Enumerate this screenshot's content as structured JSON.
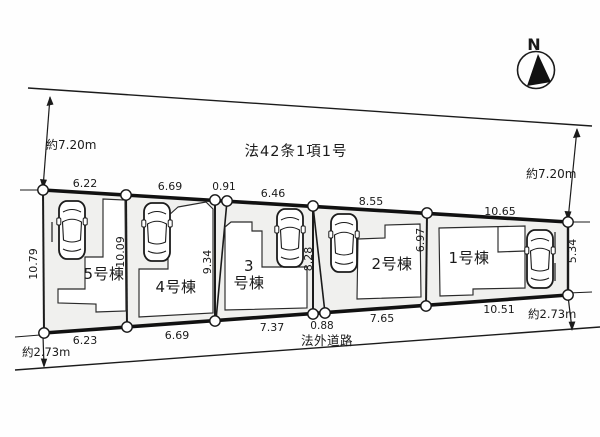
{
  "plan": {
    "compass": {
      "label": "N"
    },
    "north_road": {
      "designation": "法42条1項1号",
      "width_left": "約7.20m",
      "width_right": "約7.20m"
    },
    "south_road": {
      "name": "法外道路",
      "width_left": "約2.73m",
      "width_right": "約2.73m"
    },
    "lots": [
      {
        "label": "1号棟",
        "frontage_top": "10.65",
        "frontage_bottom": "10.51",
        "depth_right": "5.34",
        "depth_left": "6.97"
      },
      {
        "label": "2号棟",
        "frontage_top": "8.55",
        "frontage_bottom": "7.65"
      },
      {
        "label": "3号棟",
        "label_line1": "3",
        "label_line2": "号棟",
        "frontage_top": "6.46",
        "frontage_bottom": "7.37",
        "depth_left": "9.34",
        "depth_right": "8.28"
      },
      {
        "label": "4号棟",
        "frontage_top": "6.69",
        "frontage_bottom": "6.69"
      },
      {
        "label": "5号棟",
        "frontage_top": "6.22",
        "frontage_bottom": "6.23",
        "depth_left": "10.79",
        "depth_right": "10.09"
      }
    ],
    "dims": {
      "top": [
        "6.22",
        "6.69",
        "0.91",
        "6.46",
        "8.55",
        "10.65"
      ],
      "bottom": [
        "6.23",
        "6.69",
        "7.37",
        "0.88",
        "7.65",
        "10.51"
      ],
      "vertical": [
        "10.79",
        "10.09",
        "9.34",
        "8.28",
        "6.97",
        "5.34"
      ]
    }
  }
}
